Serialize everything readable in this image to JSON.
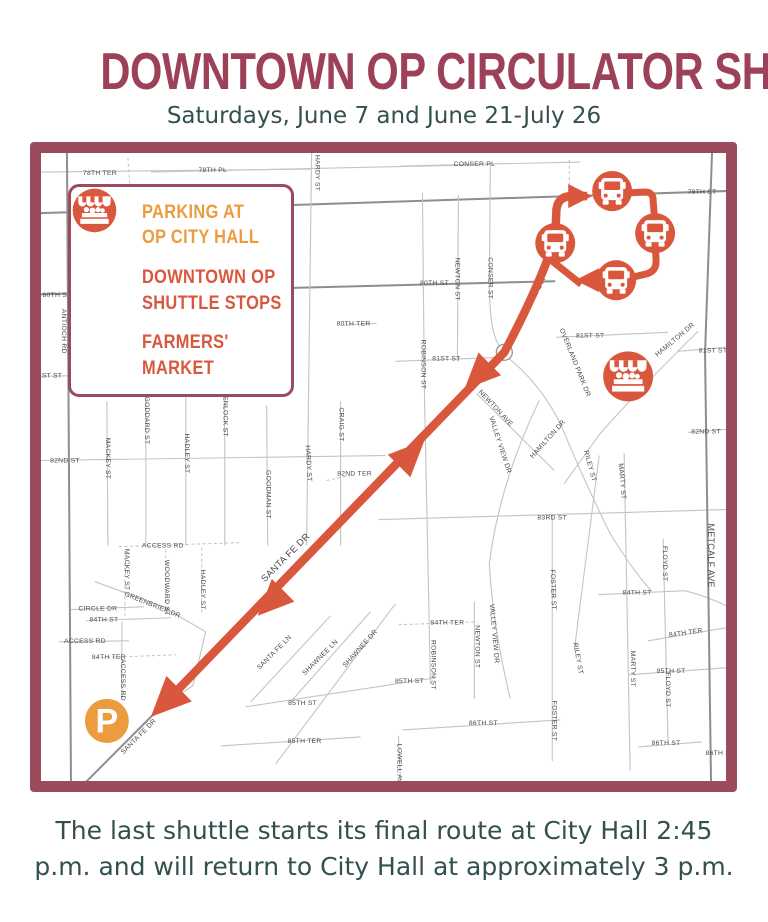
{
  "title": "DOWNTOWN OP CIRCULATOR SHUTTLE",
  "subtitle": "Saturdays, June 7 and June 21-July 26",
  "footer": {
    "line1": "The last shuttle starts its final route at City Hall 2:45",
    "line2": "p.m. and will return to City Hall at approximately 3 p.m."
  },
  "colors": {
    "title": "#9D4158",
    "subtitle": "#33504F",
    "border": "#9C4B5C",
    "orange": "#EA9C3E",
    "red": "#D9573C",
    "road": "#C4C4C4",
    "road_major": "#8E8E8E",
    "street_label": "#4A4A4A"
  },
  "legend": {
    "items": [
      {
        "id": "parking",
        "icon": "parking-icon",
        "line1": "PARKING AT",
        "line2": "OP CITY HALL",
        "color": "#EA9C3E"
      },
      {
        "id": "shuttle-stops",
        "icon": "bus-icon",
        "line1": "DOWNTOWN OP",
        "line2": "SHUTTLE STOPS",
        "color": "#D9573C"
      },
      {
        "id": "farmers-market",
        "icon": "market-icon",
        "line1": "FARMERS'",
        "line2": "MARKET",
        "color": "#D9573C"
      }
    ]
  },
  "map": {
    "roads": [
      {
        "d": "M0,19 L271,16"
      },
      {
        "d": "M110,19 L430,12"
      },
      {
        "d": "M360,13 L540,9"
      },
      {
        "d": "M0,60 L686,38",
        "c": "major"
      },
      {
        "d": "M0,141 L515,128",
        "c": "major"
      },
      {
        "d": "M300,172 L336,170"
      },
      {
        "d": "M0,223 L108,221"
      },
      {
        "d": "M355,208 L462,204"
      },
      {
        "d": "M516,184 L628,179"
      },
      {
        "d": "M638,198 L686,194"
      },
      {
        "d": "M0,307 L345,302"
      },
      {
        "d": "M286,327 L310,322",
        "c": "dash"
      },
      {
        "d": "M648,279 L686,276"
      },
      {
        "d": "M338,366 L686,356"
      },
      {
        "d": "M78,393 L200,389",
        "c": "dash"
      },
      {
        "d": "M28,456 L103,453"
      },
      {
        "d": "M45,467 L130,464"
      },
      {
        "d": "M18,488 L88,487"
      },
      {
        "d": "M55,504 L135,501",
        "c": "dash"
      },
      {
        "d": "M558,441 L645,437 Q668,443 686,452"
      },
      {
        "d": "M358,471 L437,468",
        "c": "dash"
      },
      {
        "d": "M608,487 L686,474"
      },
      {
        "d": "M205,553 L395,524"
      },
      {
        "d": "M588,521 L686,514"
      },
      {
        "d": "M180,592 L320,583"
      },
      {
        "d": "M362,576 L520,566"
      },
      {
        "d": "M598,593 L662,588"
      },
      {
        "d": "M26,0 L30,627",
        "c": "major"
      },
      {
        "d": "M271,0 L266,392"
      },
      {
        "d": "M382,40 L384,240 L390,530"
      },
      {
        "d": "M418,42 L417,208"
      },
      {
        "d": "M450,10 L449,130 Q449,185 462,196"
      },
      {
        "d": "M434,448 L434,545"
      },
      {
        "d": "M512,362 L512,607"
      },
      {
        "d": "M559,302 L534,497"
      },
      {
        "d": "M584,300 L590,617"
      },
      {
        "d": "M623,385 L628,590"
      },
      {
        "d": "M672,0 L665,200 L671,627",
        "c": "major"
      },
      {
        "d": "M358,582 L360,627"
      },
      {
        "d": "M66,248 L67,392"
      },
      {
        "d": "M105,245 L105,392"
      },
      {
        "d": "M145,243 L145,392"
      },
      {
        "d": "M184,240 L184,392"
      },
      {
        "d": "M226,252 L227,392"
      },
      {
        "d": "M300,248 L300,392"
      },
      {
        "d": "M84,398 L84,462",
        "c": "dash"
      },
      {
        "d": "M125,396 L125,462",
        "c": "dash"
      },
      {
        "d": "M161,394 L161,460",
        "c": "dash"
      },
      {
        "d": "M81,468 L81,545"
      },
      {
        "d": "M54,428 L120,452 L165,478"
      },
      {
        "d": "M165,478 L152,532 L122,551"
      },
      {
        "d": "M210,548 L290,462"
      },
      {
        "d": "M250,548 L330,458"
      },
      {
        "d": "M235,610 L355,450"
      },
      {
        "d": "M499,247 Q459,330 449,410 Q452,470 470,545"
      },
      {
        "d": "M658,178 Q600,235 560,280 L524,330"
      },
      {
        "d": "M466,203 Q500,230 520,270 Q545,330 570,380 Q595,420 612,438"
      },
      {
        "d": "M436,240 L514,317"
      },
      {
        "d": "M122,551 L40,633",
        "c": "major"
      },
      {
        "d": "M529,7 L529,37",
        "c": "dash"
      },
      {
        "d": "M87,5 L89,32",
        "c": "dash"
      }
    ],
    "street_labels": [
      {
        "t": "78TH TER",
        "x": 59,
        "y": 22
      },
      {
        "t": "78TH PL",
        "x": 172,
        "y": 19
      },
      {
        "t": "CONSER PL",
        "x": 434,
        "y": 13
      },
      {
        "t": "79TH ST",
        "x": 662,
        "y": 41
      },
      {
        "t": "80TH ST",
        "x": 16,
        "y": 144
      },
      {
        "t": "80TH ST",
        "x": 394,
        "y": 132
      },
      {
        "t": "80TH TER",
        "x": 313,
        "y": 172
      },
      {
        "t": "81ST ST",
        "x": 7,
        "y": 224
      },
      {
        "t": "81ST ST",
        "x": 406,
        "y": 207
      },
      {
        "t": "81ST ST",
        "x": 550,
        "y": 184
      },
      {
        "t": "81ST ST",
        "x": 673,
        "y": 199
      },
      {
        "t": "82ND ST",
        "x": 24,
        "y": 309
      },
      {
        "t": "82ND TER",
        "x": 314,
        "y": 322
      },
      {
        "t": "82ND ST",
        "x": 666,
        "y": 280
      },
      {
        "t": "83RD ST",
        "x": 512,
        "y": 366
      },
      {
        "t": "ACCESS RD",
        "x": 122,
        "y": 394
      },
      {
        "t": "CIRCLE DR",
        "x": 57,
        "y": 457
      },
      {
        "t": "84TH ST",
        "x": 63,
        "y": 468
      },
      {
        "t": "ACCESS RD",
        "x": 44,
        "y": 489
      },
      {
        "t": "84TH TER",
        "x": 68,
        "y": 505
      },
      {
        "t": "84TH ST",
        "x": 597,
        "y": 441
      },
      {
        "t": "84TH TER",
        "x": 407,
        "y": 471
      },
      {
        "t": "84TH TER",
        "x": 646,
        "y": 481,
        "r": -8
      },
      {
        "t": "85TH ST",
        "x": 262,
        "y": 551
      },
      {
        "t": "85TH ST",
        "x": 369,
        "y": 529
      },
      {
        "t": "85TH ST",
        "x": 631,
        "y": 519
      },
      {
        "t": "85TH TER",
        "x": 264,
        "y": 589
      },
      {
        "t": "86TH ST",
        "x": 443,
        "y": 571
      },
      {
        "t": "86TH ST",
        "x": 626,
        "y": 591
      },
      {
        "t": "86TH ST",
        "x": 680,
        "y": 601
      },
      {
        "t": "ANTIOCH RD",
        "x": 21,
        "y": 178,
        "r": 90
      },
      {
        "t": "HARDY ST",
        "x": 275,
        "y": 20,
        "r": 90
      },
      {
        "t": "HARDY ST",
        "x": 266,
        "y": 310,
        "r": 87
      },
      {
        "t": "MACKEY ST",
        "x": 65,
        "y": 305,
        "r": 90
      },
      {
        "t": "GODDARD ST",
        "x": 104,
        "y": 267,
        "r": 90
      },
      {
        "t": "HADLEY ST",
        "x": 144,
        "y": 300,
        "r": 90
      },
      {
        "t": "ENLOCK ST",
        "x": 183,
        "y": 263,
        "r": 90
      },
      {
        "t": "GOODMAN ST",
        "x": 226,
        "y": 341,
        "r": 90
      },
      {
        "t": "CRAIG ST",
        "x": 299,
        "y": 271,
        "r": 90
      },
      {
        "t": "ROBINSON ST",
        "x": 381,
        "y": 211,
        "r": 90
      },
      {
        "t": "ROBINSON ST",
        "x": 391,
        "y": 511,
        "r": 90
      },
      {
        "t": "NEWTON ST",
        "x": 415,
        "y": 126,
        "r": 90
      },
      {
        "t": "NEWTON ST",
        "x": 435,
        "y": 493,
        "r": 90
      },
      {
        "t": "CONSER ST",
        "x": 448,
        "y": 125,
        "r": 90
      },
      {
        "t": "FOSTER ST",
        "x": 511,
        "y": 436,
        "r": 88
      },
      {
        "t": "FOSTER ST",
        "x": 512,
        "y": 567,
        "r": 90
      },
      {
        "t": "RILEY ST",
        "x": 548,
        "y": 313,
        "r": 75
      },
      {
        "t": "RILEY ST",
        "x": 536,
        "y": 505,
        "r": 80
      },
      {
        "t": "MARTY ST",
        "x": 580,
        "y": 328,
        "r": 85
      },
      {
        "t": "MARTY ST",
        "x": 591,
        "y": 515,
        "r": 90
      },
      {
        "t": "FLOYD ST",
        "x": 623,
        "y": 410,
        "r": 90
      },
      {
        "t": "FLOYD ST",
        "x": 626,
        "y": 536,
        "r": 90
      },
      {
        "t": "METCALF AVE",
        "x": 668,
        "y": 402,
        "r": 90,
        "s": 9
      },
      {
        "t": "LOWELL AVE",
        "x": 357,
        "y": 612,
        "r": 90
      },
      {
        "t": "MACKEY ST",
        "x": 84,
        "y": 416,
        "r": 90
      },
      {
        "t": "WOODWARD ST",
        "x": 124,
        "y": 434,
        "r": 90
      },
      {
        "t": "HADLEY ST",
        "x": 160,
        "y": 436,
        "r": 90
      },
      {
        "t": "ACCESS RD",
        "x": 80,
        "y": 526,
        "r": 90
      },
      {
        "t": "GREENBRIER DR",
        "x": 111,
        "y": 453,
        "r": 22
      },
      {
        "t": "SANTA FE LN",
        "x": 235,
        "y": 500,
        "r": -45
      },
      {
        "t": "SHAWNEE LN",
        "x": 281,
        "y": 505,
        "r": -45
      },
      {
        "t": "SHAWNEE DR",
        "x": 321,
        "y": 496,
        "r": -48
      },
      {
        "t": "VALLEY VIEW DR",
        "x": 458,
        "y": 292,
        "r": 72
      },
      {
        "t": "VALLEY VIEW DR",
        "x": 452,
        "y": 480,
        "r": 85
      },
      {
        "t": "HAMILTON DR",
        "x": 636,
        "y": 188,
        "r": -40
      },
      {
        "t": "HAMILTON DR",
        "x": 509,
        "y": 287,
        "r": -48
      },
      {
        "t": "OVERLAND PARK DR",
        "x": 533,
        "y": 210,
        "r": 68
      },
      {
        "t": "NEWTON AVE",
        "x": 454,
        "y": 256,
        "r": 47
      },
      {
        "t": "SANTA FE DR",
        "x": 492,
        "y": 151,
        "r": -62,
        "s": 8.5
      },
      {
        "t": "SANTA FE DR",
        "x": 247,
        "y": 406,
        "r": -45,
        "s": 9.5
      },
      {
        "t": "SANTA FE DR",
        "x": 99,
        "y": 584,
        "r": -45
      }
    ],
    "roundabout": {
      "x": 464,
      "y": 199,
      "r": 8
    },
    "route": {
      "color": "#D9573C",
      "paths": [
        {
          "d": "M134,539 L464,199 Q492,146 507,107 Q515,96 515,86 L516,60 Q516,43 532,43 L547,43",
          "w": 8.5
        },
        {
          "d": "M583,40 L605,39 Q613,39 613,47 L615,73",
          "w": 7
        },
        {
          "d": "M615,88 L616,108 Q616,119 605,121 L584,126",
          "w": 7
        },
        {
          "d": "M563,127 L550,127",
          "w": 7
        },
        {
          "d": "M541,131 L512,108",
          "w": 7
        }
      ],
      "arrows": [
        {
          "x": 424,
          "y": 236,
          "a": 135,
          "l": 36,
          "w": 16
        },
        {
          "x": 384,
          "y": 287,
          "a": 315,
          "l": 36,
          "w": 16
        },
        {
          "x": 217,
          "y": 462,
          "a": 135,
          "l": 36,
          "w": 16
        },
        {
          "x": 110,
          "y": 563,
          "a": 135,
          "l": 40,
          "w": 18
        },
        {
          "x": 552,
          "y": 43,
          "a": 0,
          "l": 24,
          "w": 12
        },
        {
          "x": 535,
          "y": 127,
          "a": 180,
          "l": 24,
          "w": 12
        }
      ]
    },
    "shuttle_stops": [
      {
        "x": 572,
        "y": 38,
        "r": 20
      },
      {
        "x": 615,
        "y": 80,
        "r": 20
      },
      {
        "x": 576,
        "y": 127,
        "r": 20
      },
      {
        "x": 515,
        "y": 90,
        "r": 20
      }
    ],
    "farmers_market": {
      "x": 588,
      "y": 223,
      "r": 25
    },
    "parking": {
      "x": 66,
      "y": 567,
      "r": 22
    }
  }
}
